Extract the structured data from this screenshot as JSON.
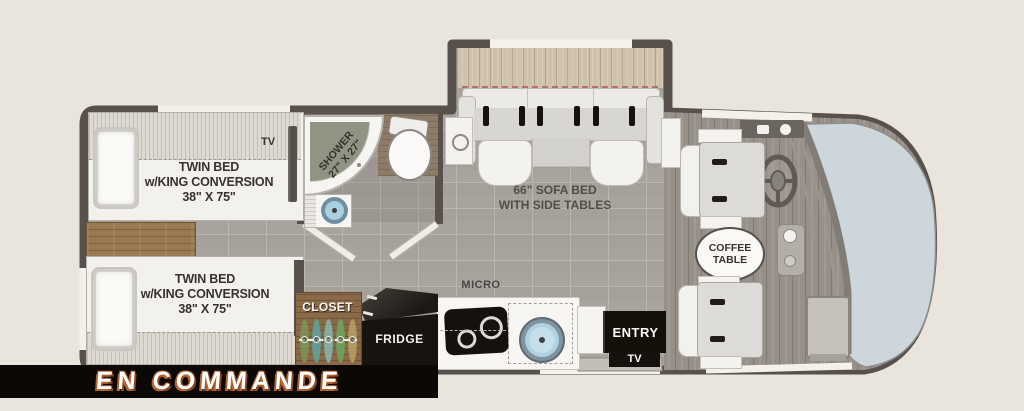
{
  "bedroom": {
    "bed_top": {
      "line1": "TWIN BED",
      "line2": "w/KING CONVERSION",
      "line3": "38\" X 75\""
    },
    "bed_bottom": {
      "line1": "TWIN BED",
      "line2": "w/KING CONVERSION",
      "line3": "38\" X 75\""
    },
    "tv_label": "TV"
  },
  "bathroom": {
    "shower_line1": "SHOWER",
    "shower_line2": "27\" X 27\""
  },
  "living": {
    "sofa_line1": "66\" SOFA BED",
    "sofa_line2": "WITH SIDE TABLES",
    "coffee_line1": "COFFEE",
    "coffee_line2": "TABLE"
  },
  "kitchen": {
    "micro_label": "MICRO",
    "fridge_label": "FRIDGE",
    "closet_label": "CLOSET"
  },
  "entry": {
    "entry_label": "ENTRY",
    "tv_label": "TV"
  },
  "banner": {
    "label": "EN COMMANDE"
  },
  "colors": {
    "background": "#eae5dc",
    "wall": "#57504b",
    "floor_tile": "#a8a39d",
    "cab_floor": "#979088",
    "windshield": "#cdd6da",
    "wood": "#9a7850",
    "sink_blue": "#aed2e0",
    "banner_bg": "#0b0806",
    "banner_text": "#ffffff",
    "banner_shadow": "#b5622e"
  }
}
